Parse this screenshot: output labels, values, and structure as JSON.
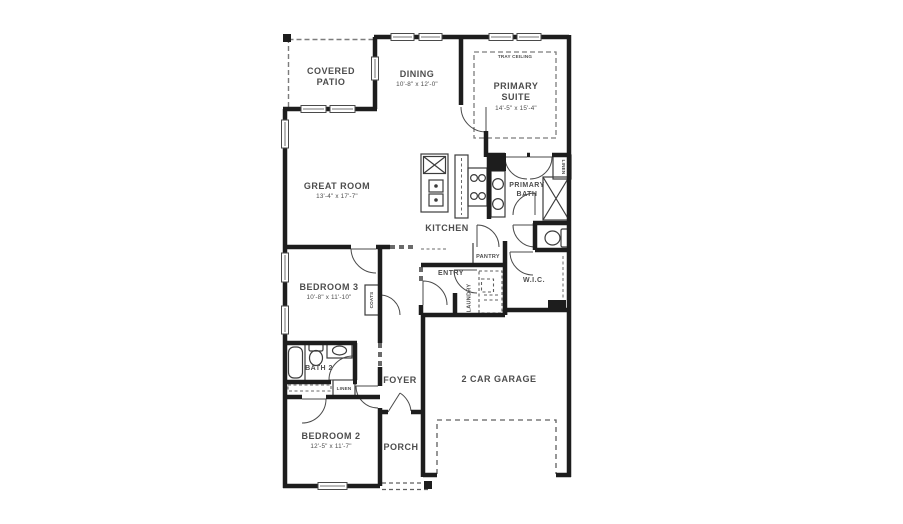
{
  "colors": {
    "wall": "#1d1d1d",
    "text": "#4d4d4d",
    "fixture": "#3c3c3c",
    "dash": "#6a6a6a",
    "background": "#ffffff"
  },
  "rooms": {
    "covered_patio": {
      "label": "COVERED PATIO"
    },
    "dining": {
      "label": "DINING",
      "dims": "10'-8\" x 12'-0\""
    },
    "primary_suite": {
      "label": "PRIMARY SUITE",
      "dims": "14'-5\" x 15'-4\"",
      "feature": "TRAY CEILING"
    },
    "great_room": {
      "label": "GREAT ROOM",
      "dims": "13'-4\" x 17'-7\""
    },
    "kitchen": {
      "label": "KITCHEN"
    },
    "primary_bath": {
      "label": "PRIMARY BATH"
    },
    "bedroom_3": {
      "label": "BEDROOM 3",
      "dims": "10'-8\" x 11'-10\""
    },
    "bath_2": {
      "label": "BATH 2"
    },
    "bedroom_2": {
      "label": "BEDROOM 2",
      "dims": "12'-5\" x 11'-7\""
    },
    "foyer": {
      "label": "FOYER"
    },
    "porch": {
      "label": "PORCH"
    },
    "garage": {
      "label": "2 CAR GARAGE"
    },
    "entry": {
      "label": "ENTRY"
    },
    "pantry": {
      "label": "PANTRY"
    },
    "laundry": {
      "label": "LAUNDRY"
    },
    "wic": {
      "label": "W.I.C."
    },
    "coats": {
      "label": "COATS"
    },
    "linen_primary": {
      "label": "LINEN"
    },
    "linen_hall": {
      "label": "LINEN"
    }
  }
}
